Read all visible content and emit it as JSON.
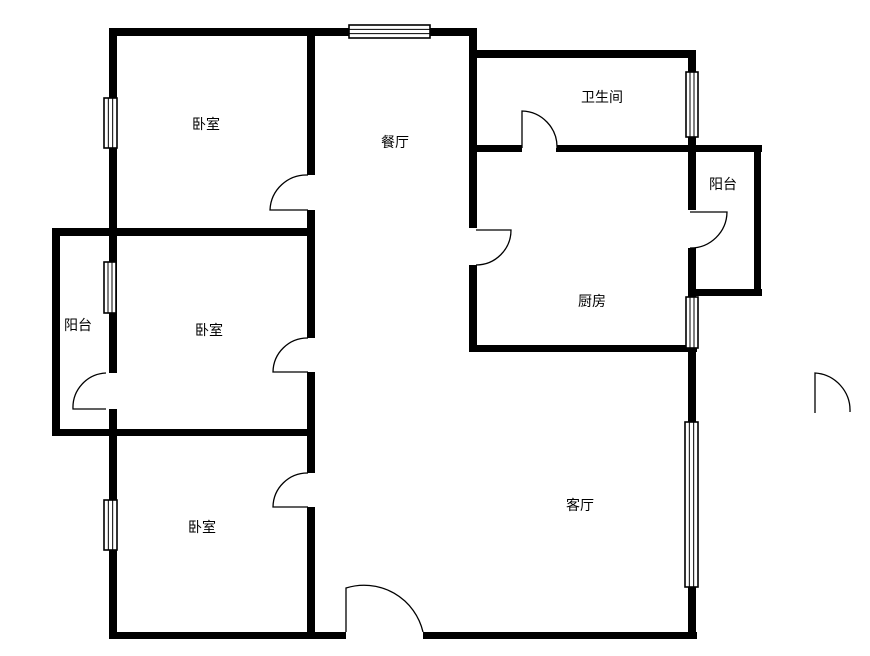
{
  "canvas": {
    "width": 870,
    "height": 656,
    "background": "#ffffff",
    "wall_color": "#000000",
    "line_color": "#000000"
  },
  "rooms": [
    {
      "key": "bedroom-top",
      "label": "卧室",
      "cx": 206,
      "cy": 124
    },
    {
      "key": "dining",
      "label": "餐厅",
      "cx": 395,
      "cy": 142
    },
    {
      "key": "bathroom",
      "label": "卫生间",
      "cx": 602,
      "cy": 97
    },
    {
      "key": "balcony-right",
      "label": "阳台",
      "cx": 723,
      "cy": 184
    },
    {
      "key": "kitchen",
      "label": "厨房",
      "cx": 592,
      "cy": 301
    },
    {
      "key": "balcony-left",
      "label": "阳台",
      "cx": 78,
      "cy": 325
    },
    {
      "key": "bedroom-middle",
      "label": "卧室",
      "cx": 209,
      "cy": 330
    },
    {
      "key": "bedroom-bottom",
      "label": "卧室",
      "cx": 202,
      "cy": 527
    },
    {
      "key": "living",
      "label": "客厅",
      "cx": 580,
      "cy": 505
    }
  ],
  "floorplan": {
    "walls": [
      {
        "name": "wall-top-outer",
        "x": 110,
        "y": 28,
        "w": 367,
        "h": 8
      },
      {
        "name": "wall-bathroom-top",
        "x": 469,
        "y": 50,
        "w": 227,
        "h": 8
      },
      {
        "name": "wall-bathroom-bottom-left",
        "x": 469,
        "y": 145,
        "w": 53,
        "h": 7
      },
      {
        "name": "wall-bathroom-bottom-right",
        "x": 556,
        "y": 145,
        "w": 206,
        "h": 7
      },
      {
        "name": "wall-balcony-right-bottom",
        "x": 688,
        "y": 289,
        "w": 74,
        "h": 7
      },
      {
        "name": "wall-kitchen-bottom",
        "x": 469,
        "y": 345,
        "w": 228,
        "h": 7
      },
      {
        "name": "wall-bedroom1-bottom",
        "x": 52,
        "y": 228,
        "w": 263,
        "h": 8
      },
      {
        "name": "wall-bedroom2-bottom",
        "x": 52,
        "y": 429,
        "w": 261,
        "h": 7
      },
      {
        "name": "wall-bottom-outer-left",
        "x": 109,
        "y": 632,
        "w": 237,
        "h": 7
      },
      {
        "name": "wall-bottom-outer-right",
        "x": 423,
        "y": 632,
        "w": 274,
        "h": 7
      },
      {
        "name": "wall-balcony-left-outer",
        "x": 52,
        "y": 228,
        "w": 8,
        "h": 208
      },
      {
        "name": "wall-left-outer-upper",
        "x": 109,
        "y": 28,
        "w": 8,
        "h": 345
      },
      {
        "name": "wall-left-outer-lower",
        "x": 109,
        "y": 409,
        "w": 8,
        "h": 230
      },
      {
        "name": "wall-center-vertical-a",
        "x": 307,
        "y": 28,
        "w": 8,
        "h": 147
      },
      {
        "name": "wall-center-vertical-b",
        "x": 307,
        "y": 210,
        "w": 8,
        "h": 128
      },
      {
        "name": "wall-center-vertical-c",
        "x": 307,
        "y": 372,
        "w": 8,
        "h": 101
      },
      {
        "name": "wall-center-vertical-d",
        "x": 307,
        "y": 507,
        "w": 8,
        "h": 132
      },
      {
        "name": "wall-dining-kitchen-divider-upper",
        "x": 469,
        "y": 28,
        "w": 8,
        "h": 200
      },
      {
        "name": "wall-dining-kitchen-divider-lower",
        "x": 469,
        "y": 265,
        "w": 8,
        "h": 87
      },
      {
        "name": "wall-right-outer-a",
        "x": 688,
        "y": 50,
        "w": 8,
        "h": 22
      },
      {
        "name": "wall-right-outer-b",
        "x": 688,
        "y": 137,
        "w": 8,
        "h": 73
      },
      {
        "name": "wall-right-outer-c",
        "x": 688,
        "y": 248,
        "w": 8,
        "h": 49
      },
      {
        "name": "wall-right-outer-d",
        "x": 688,
        "y": 348,
        "w": 8,
        "h": 74
      },
      {
        "name": "wall-right-outer-e",
        "x": 688,
        "y": 587,
        "w": 8,
        "h": 52
      },
      {
        "name": "wall-balcony-right-outer",
        "x": 754,
        "y": 145,
        "w": 7,
        "h": 151
      }
    ],
    "windows": [
      {
        "name": "window-dining-top",
        "x": 349,
        "y": 25,
        "w": 81,
        "h": 13,
        "dir": "h"
      },
      {
        "name": "window-bathroom-right",
        "x": 686,
        "y": 72,
        "w": 12,
        "h": 65,
        "dir": "v"
      },
      {
        "name": "window-kitchen-right",
        "x": 686,
        "y": 297,
        "w": 12,
        "h": 51,
        "dir": "v"
      },
      {
        "name": "window-living-right",
        "x": 685,
        "y": 422,
        "w": 13,
        "h": 165,
        "dir": "v"
      },
      {
        "name": "window-bedroom1-left",
        "x": 104,
        "y": 98,
        "w": 13,
        "h": 50,
        "dir": "v"
      },
      {
        "name": "window-bedroom2-left",
        "x": 104,
        "y": 262,
        "w": 12,
        "h": 51,
        "dir": "v"
      },
      {
        "name": "window-bedroom3-left",
        "x": 104,
        "y": 500,
        "w": 13,
        "h": 50,
        "dir": "v"
      }
    ],
    "doors": [
      {
        "name": "door-bedroom-top",
        "hx": 308,
        "hy": 210,
        "ax": 270,
        "ay": 210,
        "bx": 308,
        "by": 175
      },
      {
        "name": "door-bathroom",
        "hx": 522,
        "hy": 148,
        "ax": 522,
        "ay": 111,
        "bx": 557,
        "by": 148
      },
      {
        "name": "door-kitchen",
        "hx": 476,
        "hy": 230,
        "ax": 511,
        "ay": 230,
        "bx": 476,
        "by": 265
      },
      {
        "name": "door-bedroom-middle",
        "hx": 308,
        "hy": 372,
        "ax": 273,
        "ay": 372,
        "bx": 308,
        "by": 338
      },
      {
        "name": "door-balcony-left",
        "hx": 106,
        "hy": 409,
        "ax": 73,
        "ay": 409,
        "bx": 106,
        "by": 373
      },
      {
        "name": "door-bedroom-bottom",
        "hx": 308,
        "hy": 507,
        "ax": 273,
        "ay": 507,
        "bx": 308,
        "by": 473
      },
      {
        "name": "door-balcony-right",
        "hx": 690,
        "hy": 212,
        "ax": 727,
        "ay": 212,
        "bx": 690,
        "by": 248
      },
      {
        "name": "door-entry",
        "hx": 346,
        "hy": 632,
        "ax": 346,
        "ay": 588,
        "bx": 423,
        "by": 632
      },
      {
        "name": "door-detached-right",
        "hx": 815,
        "hy": 413,
        "ax": 815,
        "ay": 373,
        "bx": 850,
        "by": 412
      }
    ]
  }
}
